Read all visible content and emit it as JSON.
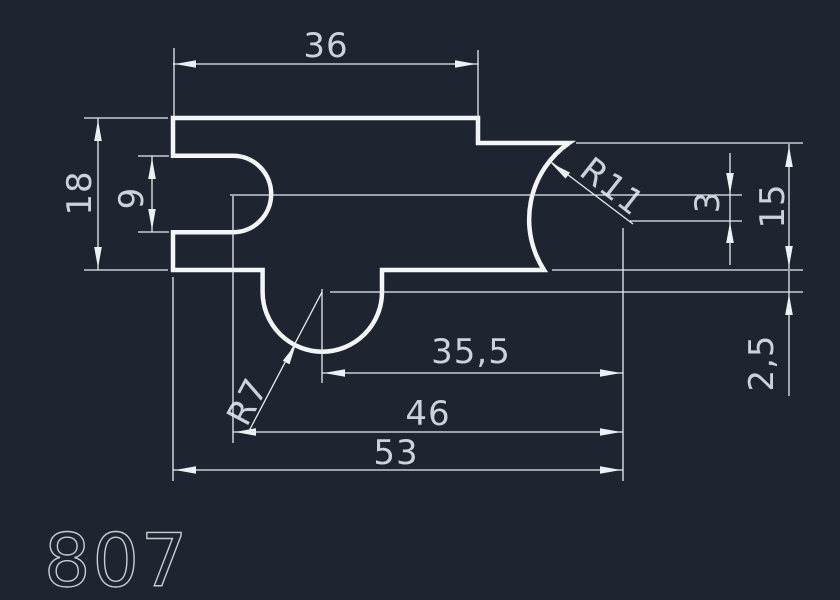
{
  "canvas": {
    "background_color": "#1f2530",
    "profile_line_color": "#f3f5f7",
    "dimension_line_color": "#e9ecf0",
    "dimension_text_color": "#ccd2da",
    "part_number_color": "#c6cbd3"
  },
  "drawing": {
    "type": "2D CAD profile cross-section",
    "part_number": "807",
    "dimensions": {
      "top_width": {
        "label": "36",
        "kind": "linear-horizontal"
      },
      "left_height": {
        "label": "18",
        "kind": "linear-vertical"
      },
      "slot_height": {
        "label": "9",
        "kind": "linear-vertical"
      },
      "right_radius": {
        "label": "R11",
        "kind": "radius"
      },
      "center_offset": {
        "label": "3",
        "kind": "linear-vertical"
      },
      "right_height": {
        "label": "15",
        "kind": "linear-vertical"
      },
      "center_distance": {
        "label": "35,5",
        "kind": "linear-horizontal"
      },
      "step_depth": {
        "label": "2,5",
        "kind": "linear-vertical"
      },
      "bottom_radius": {
        "label": "R7",
        "kind": "radius"
      },
      "mid_length": {
        "label": "46",
        "kind": "linear-horizontal"
      },
      "total_length": {
        "label": "53",
        "kind": "linear-horizontal"
      }
    }
  }
}
